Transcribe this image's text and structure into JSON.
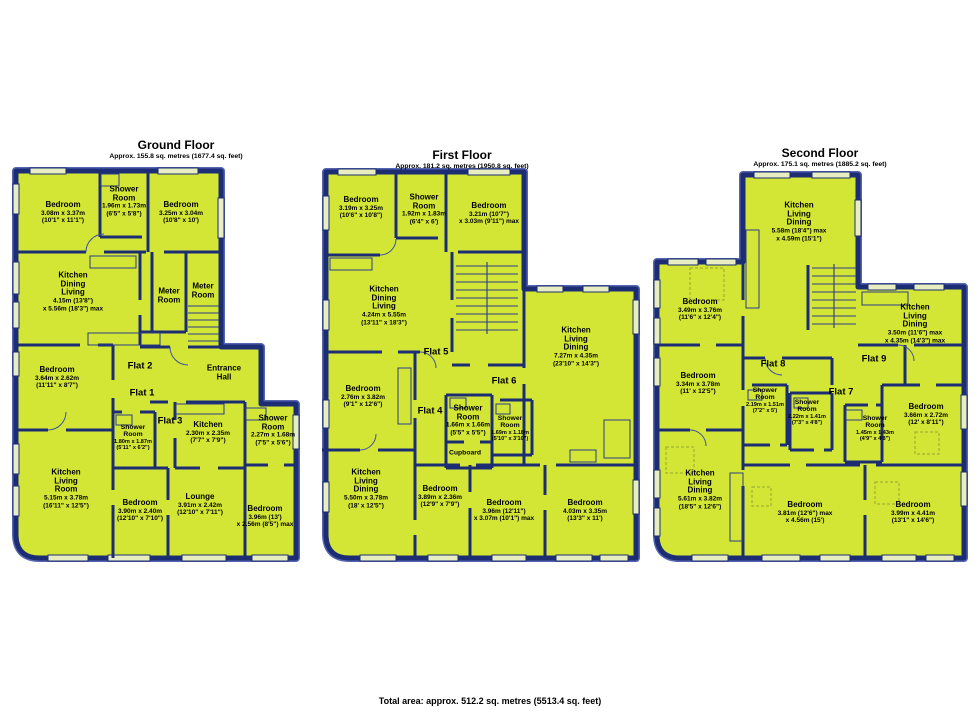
{
  "colors": {
    "background": "#ffffff",
    "floor_fill": "#d3e636",
    "wall": "#1c2d74",
    "wall_highlight": "#5565b0",
    "window_fill": "#e9edc2",
    "text": "#000000"
  },
  "footer": {
    "total": "Total area: approx. 512.2 sq. metres (5513.4 sq. feet)"
  },
  "floors": [
    {
      "title": "Ground Floor",
      "subtitle": "Approx. 155.8 sq. metres (1677.4 sq. feet)",
      "flats": [
        {
          "label": "Flat 2"
        },
        {
          "label": "Flat 1"
        },
        {
          "label": "Flat 3"
        }
      ],
      "rooms": [
        {
          "name": "Bedroom",
          "d1": "3.08m x 3.37m",
          "d2": "(10'1\" x 11'1\")"
        },
        {
          "name": "Shower\nRoom",
          "d1": "1.96m x 1.73m",
          "d2": "(6'5\" x 5'8\")"
        },
        {
          "name": "Bedroom",
          "d1": "3.25m x 3.04m",
          "d2": "(10'8\" x 10')"
        },
        {
          "name": "Kitchen\nDining\nLiving",
          "d1": "4.15m (13'8\")",
          "d2": "x 5.56m (18'3\") max"
        },
        {
          "name": "Meter\nRoom"
        },
        {
          "name": "Meter\nRoom"
        },
        {
          "name": "Bedroom",
          "d1": "3.64m x 2.62m",
          "d2": "(11'11\" x 8'7\")"
        },
        {
          "name": "Entrance\nHall"
        },
        {
          "name": "Shower\nRoom",
          "d1": "1.80m x 1.87m",
          "d2": "(5'11\" x 6'2\")"
        },
        {
          "name": "Kitchen",
          "d1": "2.30m x 2.35m",
          "d2": "(7'7\" x 7'9\")"
        },
        {
          "name": "Shower\nRoom",
          "d1": "2.27m x 1.68m",
          "d2": "(7'5\" x 5'6\")"
        },
        {
          "name": "Kitchen\nLiving\nRoom",
          "d1": "5.15m x 3.78m",
          "d2": "(16'11\" x 12'5\")"
        },
        {
          "name": "Bedroom",
          "d1": "3.90m x 2.40m",
          "d2": "(12'10\" x 7'10\")"
        },
        {
          "name": "Lounge",
          "d1": "3.91m x 2.42m",
          "d2": "(12'10\" x 7'11\")"
        },
        {
          "name": "Bedroom",
          "d1": "3.96m (13')",
          "d2": "x 2.56m (8'5\") max"
        }
      ]
    },
    {
      "title": "First Floor",
      "subtitle": "Approx. 181.2 sq. metres (1950.8 sq. feet)",
      "flats": [
        {
          "label": "Flat 5"
        },
        {
          "label": "Flat 6"
        },
        {
          "label": "Flat 4"
        }
      ],
      "rooms": [
        {
          "name": "Bedroom",
          "d1": "3.19m x 3.25m",
          "d2": "(10'6\" x 10'8\")"
        },
        {
          "name": "Shower\nRoom",
          "d1": "1.92m x 1.83m",
          "d2": "(6'4\" x 6')"
        },
        {
          "name": "Bedroom",
          "d1": "3.21m (10'7\")",
          "d2": "x 3.03m (9'11\") max"
        },
        {
          "name": "Kitchen\nDining\nLiving",
          "d1": "4.24m x 5.55m",
          "d2": "(13'11\" x 18'3\")"
        },
        {
          "name": "Kitchen\nLiving\nDining",
          "d1": "7.27m x 4.35m",
          "d2": "(23'10\" x 14'3\")"
        },
        {
          "name": "Bedroom",
          "d1": "2.76m x 3.82m",
          "d2": "(9'1\" x 12'6\")"
        },
        {
          "name": "Shower\nRoom",
          "d1": "1.66m x 1.66m",
          "d2": "(5'5\" x 5'5\")"
        },
        {
          "name": "Shower\nRoom",
          "d1": "1.69m x 1.18m",
          "d2": "(5'10\" x 3'10\")"
        },
        {
          "name": "Cupboard"
        },
        {
          "name": "Kitchen\nLiving\nDining",
          "d1": "5.50m x 3.78m",
          "d2": "(18' x 12'5\")"
        },
        {
          "name": "Bedroom",
          "d1": "3.89m x 2.36m",
          "d2": "(12'9\" x 7'9\")"
        },
        {
          "name": "Bedroom",
          "d1": "3.96m (12'11\")",
          "d2": "x 3.07m (10'1\") max"
        },
        {
          "name": "Bedroom",
          "d1": "4.03m x 3.35m",
          "d2": "(13'3\" x 11')"
        }
      ]
    },
    {
      "title": "Second Floor",
      "subtitle": "Approx. 175.1 sq. metres (1885.2 sq. feet)",
      "flats": [
        {
          "label": "Flat 8"
        },
        {
          "label": "Flat 9"
        },
        {
          "label": "Flat 7"
        }
      ],
      "rooms": [
        {
          "name": "Kitchen\nLiving\nDining",
          "d1": "5.58m (18'4\") max",
          "d2": "x 4.59m (15'1\")"
        },
        {
          "name": "Bedroom",
          "d1": "3.49m x 3.76m",
          "d2": "(11'6\" x 12'4\")"
        },
        {
          "name": "Kitchen\nLiving\nDining",
          "d1": "3.50m (11'6\") max",
          "d2": "x 4.35m (14'3\") max"
        },
        {
          "name": "Bedroom",
          "d1": "3.34m x 3.78m",
          "d2": "(11' x 12'5\")"
        },
        {
          "name": "Shower\nRoom",
          "d1": "2.19m x 1.51m",
          "d2": "(7'2\" x 5')"
        },
        {
          "name": "Shower\nRoom",
          "d1": "2.22m x 1.41m",
          "d2": "(7'3\" x 4'8\")"
        },
        {
          "name": "Shower\nRoom",
          "d1": "1.45m x 1.43m",
          "d2": "(4'9\" x 4'8\")"
        },
        {
          "name": "Bedroom",
          "d1": "3.66m x 2.72m",
          "d2": "(12' x 8'11\")"
        },
        {
          "name": "Kitchen\nLiving\nDining",
          "d1": "5.61m x 3.82m",
          "d2": "(18'5\" x 12'6\")"
        },
        {
          "name": "Bedroom",
          "d1": "3.81m (12'6\") max",
          "d2": "x 4.56m (15')"
        },
        {
          "name": "Bedroom",
          "d1": "3.99m x 4.41m",
          "d2": "(13'1\" x 14'6\")"
        }
      ]
    }
  ]
}
